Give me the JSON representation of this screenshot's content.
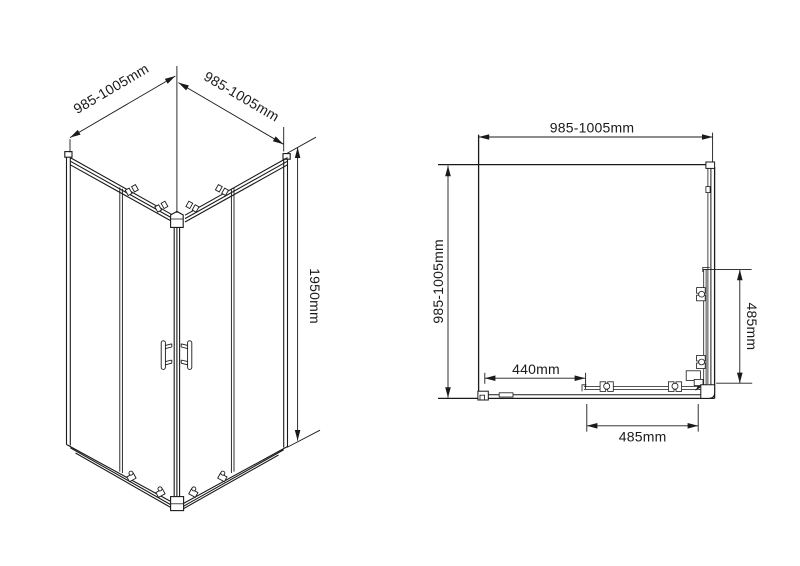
{
  "drawing": {
    "background_color": "#ffffff",
    "line_color": "#1a1a1a",
    "iso_view": {
      "dim_width_left": "985-1005mm",
      "dim_width_right": "985-1005mm",
      "dim_height": "1950mm"
    },
    "plan_view": {
      "dim_width_top": "985-1005mm",
      "dim_depth_left": "985-1005mm",
      "dim_door_offset": "440mm",
      "dim_door_width_bottom": "485mm",
      "dim_door_width_right": "485mm"
    }
  }
}
